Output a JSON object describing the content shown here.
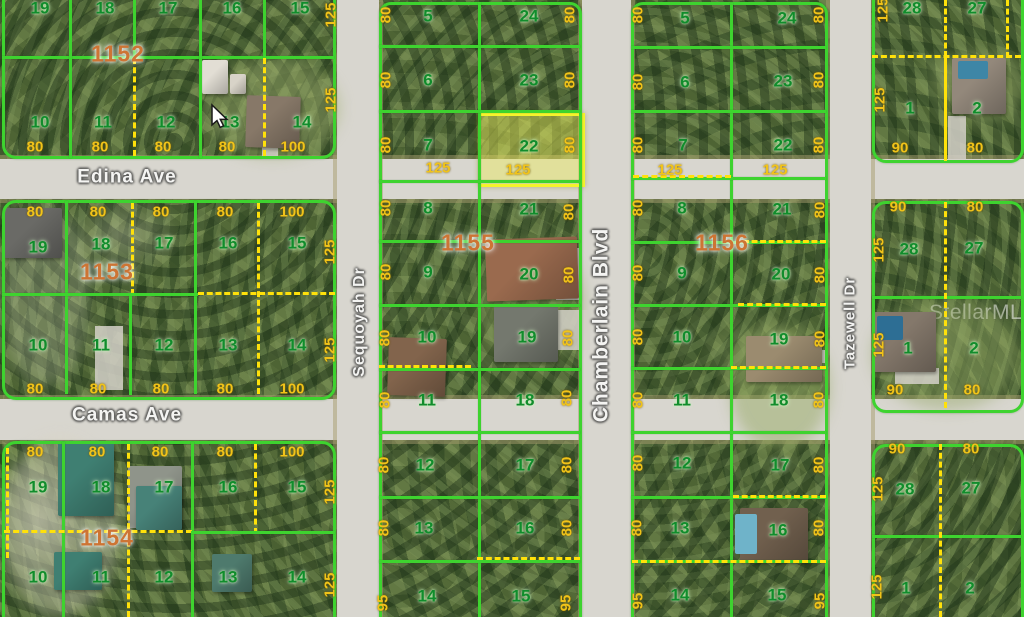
{
  "type": "aerial-plat-map-photo",
  "watermark": "StellarMLS",
  "highlight": {
    "lot": "22",
    "block": "1155"
  },
  "colors": {
    "lot_line_green": "#3ed32f",
    "boundary_dashed_yellow": "#ffe10a",
    "highlight_yellow": "#f5f32b",
    "lot_number_green": "#118c2c",
    "dimension_gold": "#f1c319",
    "block_number_orange": "#cd7434",
    "road_gray": "#d8d6cf"
  },
  "streets": [
    {
      "name": "Edina Ave",
      "x": 127,
      "y": 177,
      "rot": false,
      "size": 19
    },
    {
      "name": "Camas Ave",
      "x": 127,
      "y": 415,
      "rot": false,
      "size": 19
    },
    {
      "name": "Sequoyah Dr",
      "x": 360,
      "y": 322,
      "rot": true,
      "size": 16
    },
    {
      "name": "Chamberlain Blvd",
      "x": 601,
      "y": 325,
      "rot": true,
      "size": 21
    },
    {
      "name": "Tazewell Dr",
      "x": 850,
      "y": 323,
      "rot": true,
      "size": 15
    }
  ],
  "block_numbers": [
    {
      "id": "1152",
      "x": 118,
      "y": 54
    },
    {
      "id": "1153",
      "x": 107,
      "y": 272
    },
    {
      "id": "1154",
      "x": 107,
      "y": 538
    },
    {
      "id": "1155",
      "x": 468,
      "y": 243
    },
    {
      "id": "1156",
      "x": 722,
      "y": 243
    }
  ],
  "lot_numbers": [
    {
      "n": "19",
      "x": 40,
      "y": 8
    },
    {
      "n": "18",
      "x": 105,
      "y": 8
    },
    {
      "n": "17",
      "x": 168,
      "y": 8
    },
    {
      "n": "16",
      "x": 232,
      "y": 8
    },
    {
      "n": "15",
      "x": 300,
      "y": 8
    },
    {
      "n": "10",
      "x": 40,
      "y": 122
    },
    {
      "n": "11",
      "x": 103,
      "y": 122
    },
    {
      "n": "12",
      "x": 166,
      "y": 122
    },
    {
      "n": "13",
      "x": 230,
      "y": 122
    },
    {
      "n": "14",
      "x": 302,
      "y": 122
    },
    {
      "n": "19",
      "x": 38,
      "y": 247
    },
    {
      "n": "18",
      "x": 101,
      "y": 244
    },
    {
      "n": "17",
      "x": 164,
      "y": 243
    },
    {
      "n": "16",
      "x": 228,
      "y": 243
    },
    {
      "n": "15",
      "x": 297,
      "y": 243
    },
    {
      "n": "10",
      "x": 38,
      "y": 345
    },
    {
      "n": "11",
      "x": 101,
      "y": 345
    },
    {
      "n": "12",
      "x": 164,
      "y": 345
    },
    {
      "n": "13",
      "x": 228,
      "y": 345
    },
    {
      "n": "14",
      "x": 297,
      "y": 345
    },
    {
      "n": "19",
      "x": 38,
      "y": 487
    },
    {
      "n": "18",
      "x": 101,
      "y": 487
    },
    {
      "n": "17",
      "x": 164,
      "y": 487
    },
    {
      "n": "16",
      "x": 228,
      "y": 487
    },
    {
      "n": "15",
      "x": 297,
      "y": 487
    },
    {
      "n": "10",
      "x": 38,
      "y": 577
    },
    {
      "n": "11",
      "x": 101,
      "y": 577
    },
    {
      "n": "12",
      "x": 164,
      "y": 577
    },
    {
      "n": "13",
      "x": 228,
      "y": 577
    },
    {
      "n": "14",
      "x": 297,
      "y": 577
    },
    {
      "n": "5",
      "x": 428,
      "y": 16
    },
    {
      "n": "24",
      "x": 529,
      "y": 16
    },
    {
      "n": "6",
      "x": 428,
      "y": 80
    },
    {
      "n": "23",
      "x": 529,
      "y": 80
    },
    {
      "n": "7",
      "x": 428,
      "y": 145
    },
    {
      "n": "22",
      "x": 529,
      "y": 146
    },
    {
      "n": "8",
      "x": 428,
      "y": 208
    },
    {
      "n": "21",
      "x": 529,
      "y": 209
    },
    {
      "n": "9",
      "x": 428,
      "y": 272
    },
    {
      "n": "20",
      "x": 529,
      "y": 274
    },
    {
      "n": "10",
      "x": 427,
      "y": 337
    },
    {
      "n": "19",
      "x": 527,
      "y": 337
    },
    {
      "n": "11",
      "x": 427,
      "y": 400
    },
    {
      "n": "18",
      "x": 525,
      "y": 400
    },
    {
      "n": "12",
      "x": 425,
      "y": 465
    },
    {
      "n": "17",
      "x": 525,
      "y": 465
    },
    {
      "n": "13",
      "x": 424,
      "y": 528
    },
    {
      "n": "16",
      "x": 525,
      "y": 528
    },
    {
      "n": "14",
      "x": 427,
      "y": 596
    },
    {
      "n": "15",
      "x": 521,
      "y": 596
    },
    {
      "n": "5",
      "x": 685,
      "y": 18
    },
    {
      "n": "24",
      "x": 787,
      "y": 18
    },
    {
      "n": "6",
      "x": 685,
      "y": 82
    },
    {
      "n": "23",
      "x": 783,
      "y": 81
    },
    {
      "n": "7",
      "x": 683,
      "y": 145
    },
    {
      "n": "22",
      "x": 783,
      "y": 145
    },
    {
      "n": "8",
      "x": 682,
      "y": 208
    },
    {
      "n": "21",
      "x": 782,
      "y": 209
    },
    {
      "n": "9",
      "x": 682,
      "y": 273
    },
    {
      "n": "20",
      "x": 781,
      "y": 274
    },
    {
      "n": "10",
      "x": 682,
      "y": 337
    },
    {
      "n": "19",
      "x": 779,
      "y": 339
    },
    {
      "n": "11",
      "x": 682,
      "y": 400
    },
    {
      "n": "18",
      "x": 779,
      "y": 400
    },
    {
      "n": "12",
      "x": 682,
      "y": 463
    },
    {
      "n": "17",
      "x": 780,
      "y": 465
    },
    {
      "n": "13",
      "x": 680,
      "y": 528
    },
    {
      "n": "16",
      "x": 778,
      "y": 530
    },
    {
      "n": "14",
      "x": 680,
      "y": 595
    },
    {
      "n": "15",
      "x": 777,
      "y": 595
    },
    {
      "n": "28",
      "x": 912,
      "y": 8
    },
    {
      "n": "27",
      "x": 977,
      "y": 8
    },
    {
      "n": "1",
      "x": 910,
      "y": 108
    },
    {
      "n": "2",
      "x": 977,
      "y": 108
    },
    {
      "n": "28",
      "x": 909,
      "y": 249
    },
    {
      "n": "27",
      "x": 974,
      "y": 248
    },
    {
      "n": "1",
      "x": 908,
      "y": 348
    },
    {
      "n": "2",
      "x": 974,
      "y": 348
    },
    {
      "n": "28",
      "x": 905,
      "y": 489
    },
    {
      "n": "27",
      "x": 971,
      "y": 488
    },
    {
      "n": "1",
      "x": 906,
      "y": 588
    },
    {
      "n": "2",
      "x": 970,
      "y": 588
    }
  ],
  "dimensions": [
    {
      "v": "80",
      "x": 35,
      "y": 147
    },
    {
      "v": "80",
      "x": 100,
      "y": 147
    },
    {
      "v": "80",
      "x": 163,
      "y": 147
    },
    {
      "v": "80",
      "x": 227,
      "y": 147
    },
    {
      "v": "100",
      "x": 293,
      "y": 147
    },
    {
      "v": "80",
      "x": 35,
      "y": 212
    },
    {
      "v": "80",
      "x": 98,
      "y": 212
    },
    {
      "v": "80",
      "x": 161,
      "y": 212
    },
    {
      "v": "80",
      "x": 225,
      "y": 212
    },
    {
      "v": "100",
      "x": 292,
      "y": 212
    },
    {
      "v": "80",
      "x": 35,
      "y": 389
    },
    {
      "v": "80",
      "x": 98,
      "y": 389
    },
    {
      "v": "80",
      "x": 161,
      "y": 389
    },
    {
      "v": "80",
      "x": 225,
      "y": 389
    },
    {
      "v": "100",
      "x": 292,
      "y": 389
    },
    {
      "v": "80",
      "x": 35,
      "y": 452
    },
    {
      "v": "80",
      "x": 97,
      "y": 452
    },
    {
      "v": "80",
      "x": 160,
      "y": 452
    },
    {
      "v": "80",
      "x": 225,
      "y": 452
    },
    {
      "v": "100",
      "x": 292,
      "y": 452
    },
    {
      "v": "125",
      "x": 438,
      "y": 168
    },
    {
      "v": "125",
      "x": 518,
      "y": 170
    },
    {
      "v": "125",
      "x": 670,
      "y": 170
    },
    {
      "v": "125",
      "x": 775,
      "y": 170
    },
    {
      "v": "90",
      "x": 900,
      "y": 148
    },
    {
      "v": "80",
      "x": 975,
      "y": 148
    },
    {
      "v": "90",
      "x": 898,
      "y": 207
    },
    {
      "v": "80",
      "x": 975,
      "y": 207
    },
    {
      "v": "90",
      "x": 895,
      "y": 390
    },
    {
      "v": "80",
      "x": 972,
      "y": 390
    },
    {
      "v": "90",
      "x": 897,
      "y": 449
    },
    {
      "v": "80",
      "x": 971,
      "y": 449
    },
    {
      "v": "125",
      "x": 331,
      "y": 15,
      "rot": true
    },
    {
      "v": "125",
      "x": 331,
      "y": 100,
      "rot": true
    },
    {
      "v": "125",
      "x": 330,
      "y": 252,
      "rot": true
    },
    {
      "v": "125",
      "x": 330,
      "y": 350,
      "rot": true
    },
    {
      "v": "125",
      "x": 330,
      "y": 492,
      "rot": true
    },
    {
      "v": "125",
      "x": 330,
      "y": 585,
      "rot": true
    },
    {
      "v": "80",
      "x": 386,
      "y": 15,
      "rot": true
    },
    {
      "v": "80",
      "x": 386,
      "y": 80,
      "rot": true
    },
    {
      "v": "80",
      "x": 386,
      "y": 145,
      "rot": true
    },
    {
      "v": "80",
      "x": 386,
      "y": 208,
      "rot": true
    },
    {
      "v": "80",
      "x": 386,
      "y": 272,
      "rot": true
    },
    {
      "v": "80",
      "x": 385,
      "y": 338,
      "rot": true
    },
    {
      "v": "80",
      "x": 385,
      "y": 400,
      "rot": true
    },
    {
      "v": "80",
      "x": 384,
      "y": 465,
      "rot": true
    },
    {
      "v": "80",
      "x": 384,
      "y": 528,
      "rot": true
    },
    {
      "v": "95",
      "x": 383,
      "y": 603,
      "rot": true
    },
    {
      "v": "80",
      "x": 570,
      "y": 15,
      "rot": true
    },
    {
      "v": "80",
      "x": 570,
      "y": 80,
      "rot": true
    },
    {
      "v": "80",
      "x": 570,
      "y": 145,
      "rot": true
    },
    {
      "v": "80",
      "x": 569,
      "y": 212,
      "rot": true
    },
    {
      "v": "80",
      "x": 569,
      "y": 275,
      "rot": true
    },
    {
      "v": "80",
      "x": 568,
      "y": 338,
      "rot": true
    },
    {
      "v": "80",
      "x": 567,
      "y": 398,
      "rot": true
    },
    {
      "v": "80",
      "x": 567,
      "y": 465,
      "rot": true
    },
    {
      "v": "80",
      "x": 567,
      "y": 528,
      "rot": true
    },
    {
      "v": "95",
      "x": 566,
      "y": 603,
      "rot": true
    },
    {
      "v": "80",
      "x": 638,
      "y": 15,
      "rot": true
    },
    {
      "v": "80",
      "x": 638,
      "y": 82,
      "rot": true
    },
    {
      "v": "80",
      "x": 638,
      "y": 145,
      "rot": true
    },
    {
      "v": "80",
      "x": 638,
      "y": 208,
      "rot": true
    },
    {
      "v": "80",
      "x": 638,
      "y": 273,
      "rot": true
    },
    {
      "v": "80",
      "x": 638,
      "y": 337,
      "rot": true
    },
    {
      "v": "80",
      "x": 638,
      "y": 400,
      "rot": true
    },
    {
      "v": "80",
      "x": 638,
      "y": 463,
      "rot": true
    },
    {
      "v": "80",
      "x": 637,
      "y": 528,
      "rot": true
    },
    {
      "v": "95",
      "x": 638,
      "y": 601,
      "rot": true
    },
    {
      "v": "80",
      "x": 819,
      "y": 15,
      "rot": true
    },
    {
      "v": "80",
      "x": 819,
      "y": 80,
      "rot": true
    },
    {
      "v": "80",
      "x": 819,
      "y": 145,
      "rot": true
    },
    {
      "v": "80",
      "x": 820,
      "y": 210,
      "rot": true
    },
    {
      "v": "80",
      "x": 820,
      "y": 275,
      "rot": true
    },
    {
      "v": "80",
      "x": 820,
      "y": 339,
      "rot": true
    },
    {
      "v": "80",
      "x": 819,
      "y": 400,
      "rot": true
    },
    {
      "v": "80",
      "x": 819,
      "y": 465,
      "rot": true
    },
    {
      "v": "80",
      "x": 819,
      "y": 528,
      "rot": true
    },
    {
      "v": "95",
      "x": 820,
      "y": 601,
      "rot": true
    },
    {
      "v": "125",
      "x": 883,
      "y": 10,
      "rot": true
    },
    {
      "v": "125",
      "x": 880,
      "y": 100,
      "rot": true
    },
    {
      "v": "125",
      "x": 879,
      "y": 250,
      "rot": true
    },
    {
      "v": "125",
      "x": 879,
      "y": 345,
      "rot": true
    },
    {
      "v": "125",
      "x": 878,
      "y": 489,
      "rot": true
    },
    {
      "v": "125",
      "x": 877,
      "y": 587,
      "rot": true
    }
  ]
}
